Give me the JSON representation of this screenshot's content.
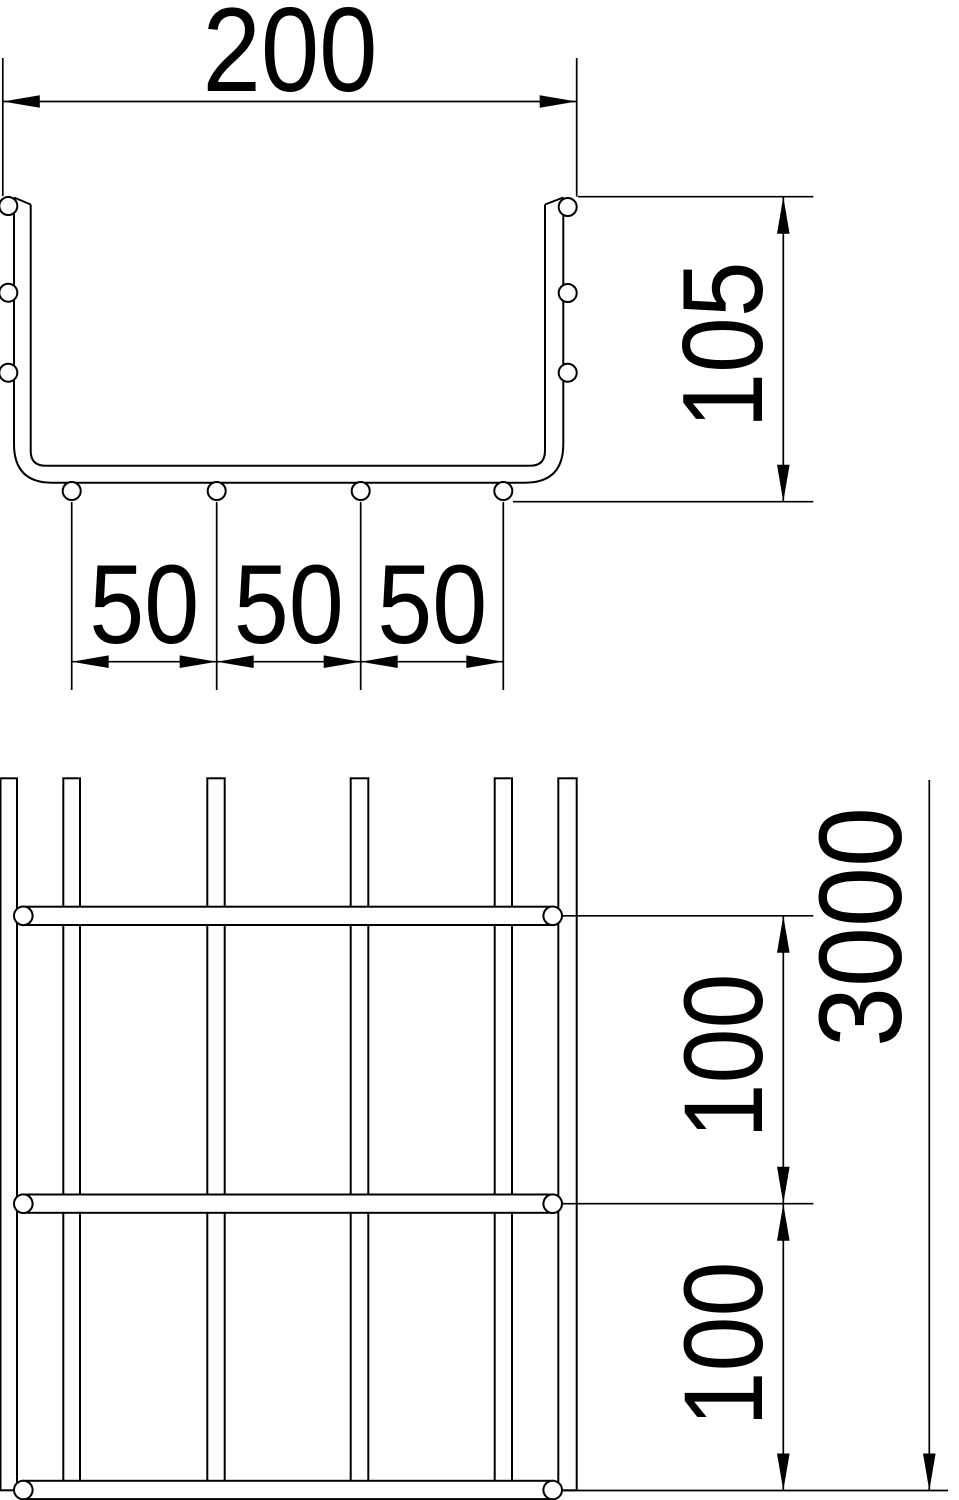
{
  "drawing_colors": {
    "line": "#000000",
    "background": "#ffffff"
  },
  "cross_section": {
    "width_label": "200",
    "height_label": "105",
    "spacing_labels": [
      "50",
      "50",
      "50"
    ]
  },
  "plan_view": {
    "pitch_labels": [
      "100",
      "100"
    ],
    "length_label": "3000"
  }
}
